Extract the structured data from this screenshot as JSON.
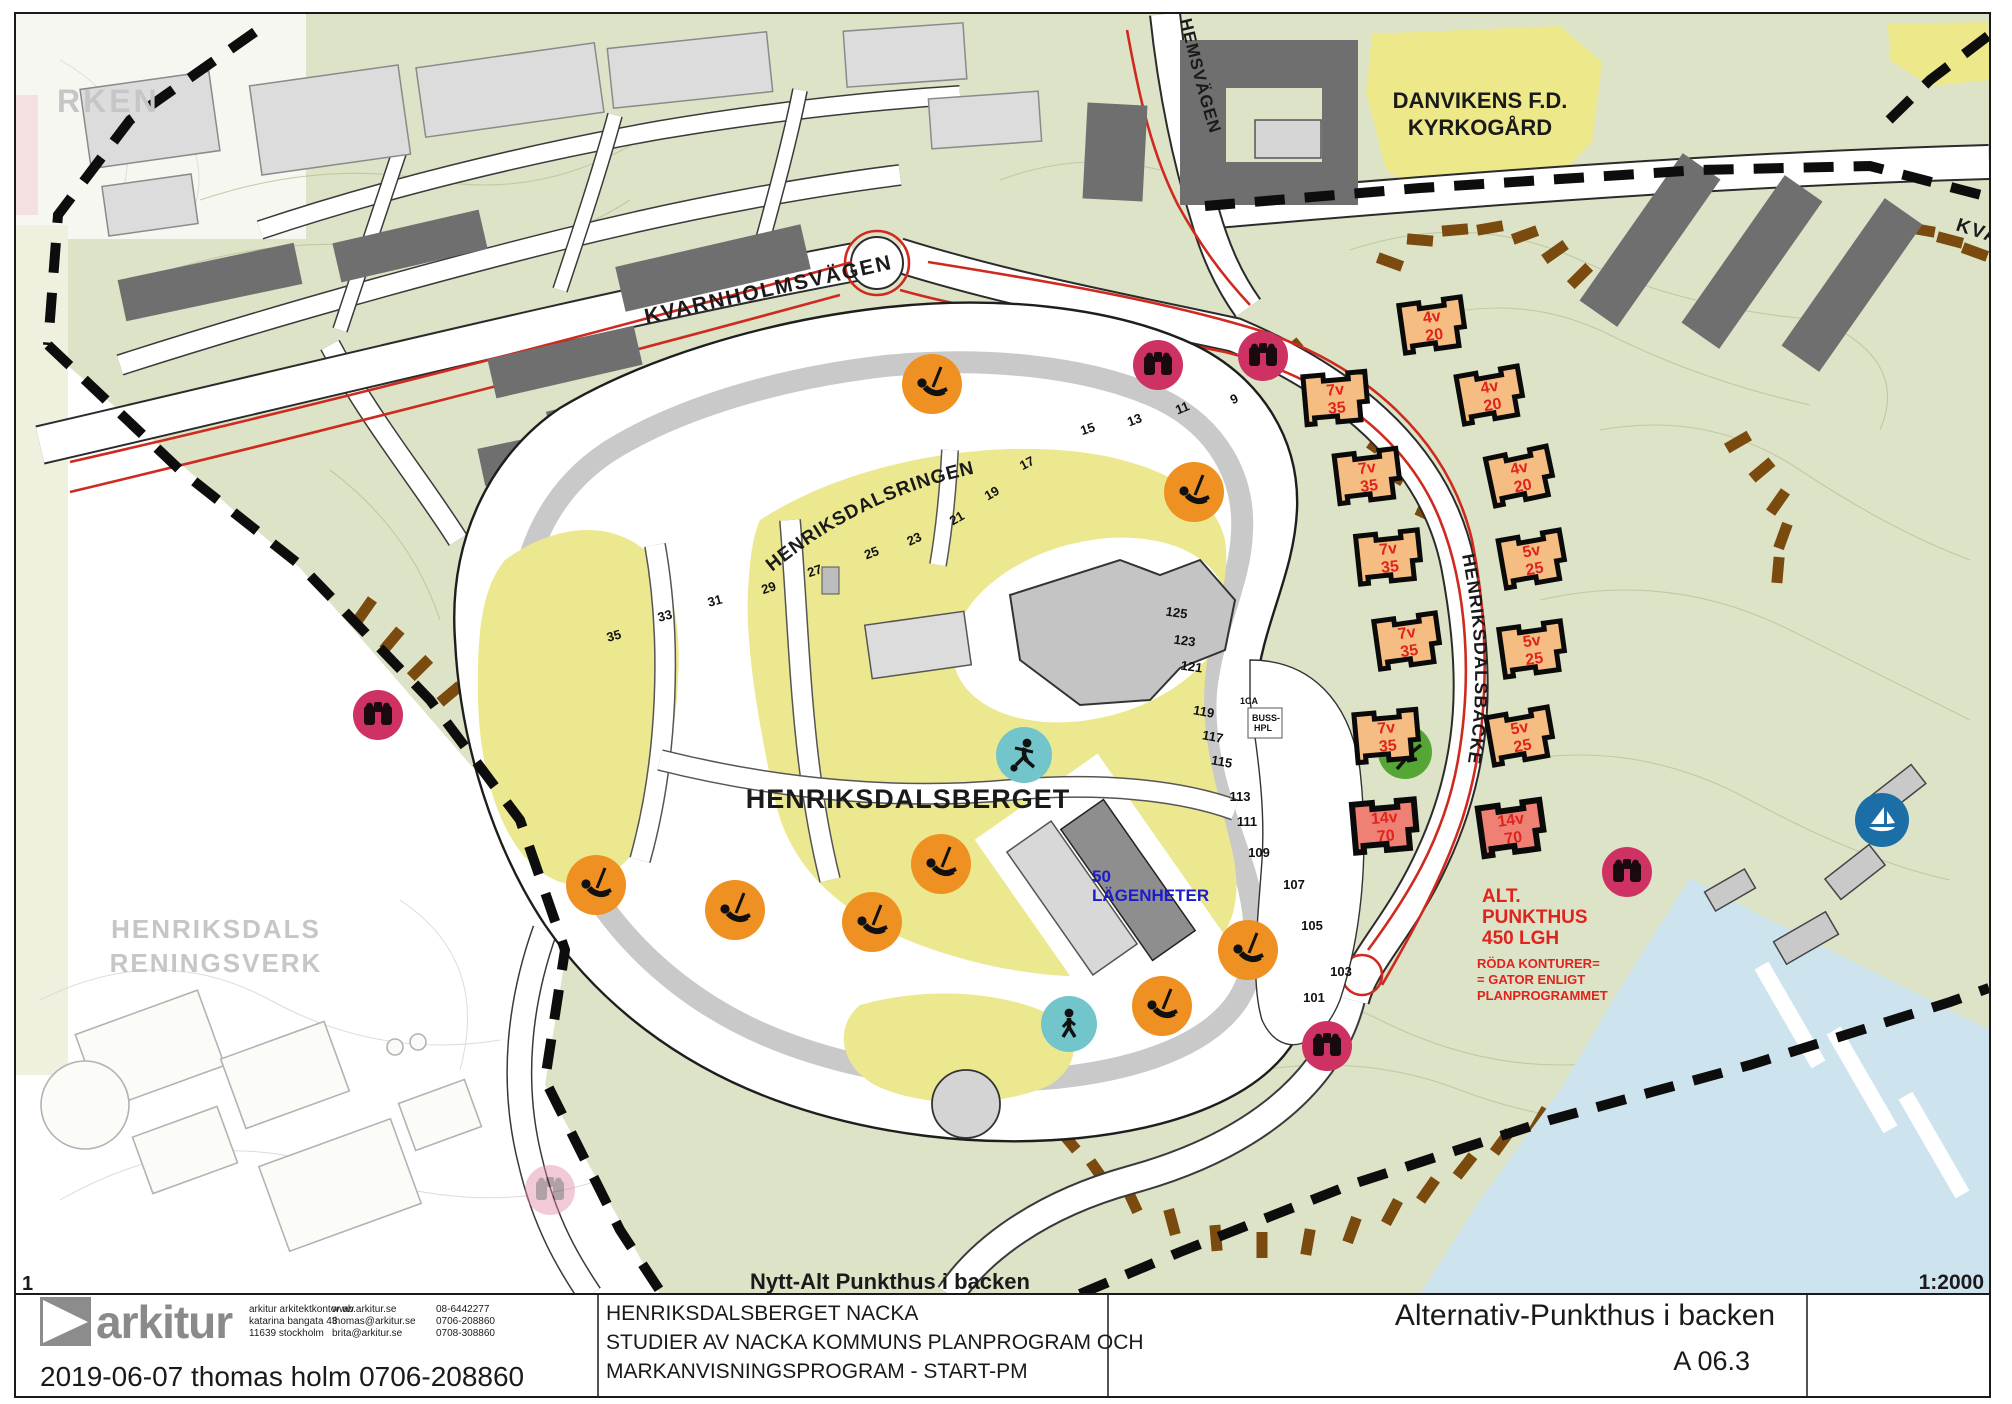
{
  "sheet": {
    "page_number": "1",
    "map_title_bottom": "Nytt-Alt Punkthus i backen",
    "scale": "1:2000",
    "drawing_title": "Alternativ-Punkthus i backen",
    "drawing_number": "A 06.3",
    "date_line": "2019-06-07  thomas holm 0706-208860",
    "project_lines": {
      "l1": "HENRIKSDALSBERGET NACKA",
      "l2": "STUDIER AV NACKA KOMMUNS PLANPROGRAM OCH",
      "l3": "MARKANVISNINGSPROGRAM - START-PM"
    },
    "logo_text": "arkitur",
    "contact": {
      "office1": "arkitur arkitektkontor ab",
      "office2": "katarina bangata 43",
      "office3": "11639 stockholm",
      "web1": "www.arkitur.se",
      "web2": "thomas@arkitur.se",
      "web3": "brita@arkitur.se",
      "tel1": "08-6442277",
      "tel2": "0706-208860",
      "tel3": "0708-308860"
    }
  },
  "map": {
    "area_labels": {
      "rken": "RKEN",
      "danvikens1": "DANVIKENS F.D.",
      "danvikens2": "KYRKOGÅRD",
      "henriksdalsberget": "HENRIKSDALSBERGET",
      "reningsverk1": "HENRIKSDALS",
      "reningsverk2": "RENINGSVERK"
    },
    "road_labels": {
      "kvarnholmsvagen": "KVARNHOLMSVÄGEN",
      "henriksdalsringen": "HENRIKSDALSRINGEN",
      "henriksdalsbacken": "HENRIKSDALSBACKEN",
      "hemsvagen": "HEMSVÄGEN",
      "kvar_partial": "KVAR"
    },
    "annotations": {
      "lgh50_1": "50",
      "lgh50_2": "LÄGENHETER",
      "alt1": "ALT.",
      "alt2": "PUNKTHUS",
      "alt3": "450 LGH",
      "rednote1": "RÖDA KONTURER=",
      "rednote2": "= GATOR ENLIGT",
      "rednote3": "PLANPROGRAMMET",
      "oneca": "1CA",
      "buss1": "BUSS-",
      "buss2": "HPL"
    },
    "punkthus": [
      {
        "floors": "4v",
        "units": "20"
      },
      {
        "floors": "7v",
        "units": "35"
      },
      {
        "floors": "4v",
        "units": "20"
      },
      {
        "floors": "7v",
        "units": "35"
      },
      {
        "floors": "4v",
        "units": "20"
      },
      {
        "floors": "7v",
        "units": "35"
      },
      {
        "floors": "5v",
        "units": "25"
      },
      {
        "floors": "7v",
        "units": "35"
      },
      {
        "floors": "5v",
        "units": "25"
      },
      {
        "floors": "7v",
        "units": "35"
      },
      {
        "floors": "5v",
        "units": "25"
      },
      {
        "floors": "14v",
        "units": "70"
      },
      {
        "floors": "14v",
        "units": "70"
      }
    ],
    "house_numbers_top": [
      "9",
      "11",
      "13",
      "15",
      "17",
      "19",
      "21",
      "23",
      "25",
      "27",
      "29",
      "31",
      "33",
      "35"
    ],
    "house_numbers_right": [
      "125",
      "123",
      "121",
      "119",
      "117",
      "115",
      "113",
      "111",
      "109",
      "107",
      "105",
      "103",
      "101"
    ],
    "icons": {
      "viewpoint": "binoculars-viewpoint",
      "playground": "playground-swing",
      "activity": "person-activity",
      "walker": "person-walking",
      "tree": "tree-branch",
      "marina": "sailboat"
    },
    "colors": {
      "terrain_green": "#dce3c6",
      "park_yellow": "#ece88f",
      "cemetery_yellow": "#ede98b",
      "building_dark": "#6f6f6f",
      "building_light": "#d3d3d3",
      "brown_dash": "#7b4a0e",
      "viewpoint_pink": "#ce3263",
      "playground_orange": "#ef9122",
      "activity_teal": "#72c5cb",
      "tree_green": "#55a635",
      "marina_blue": "#1b6ea6",
      "plan_red": "#cf2a20",
      "text_red": "#e0231c",
      "text_blue": "#1c1ccc",
      "water_blue": "#cde4ef"
    }
  }
}
